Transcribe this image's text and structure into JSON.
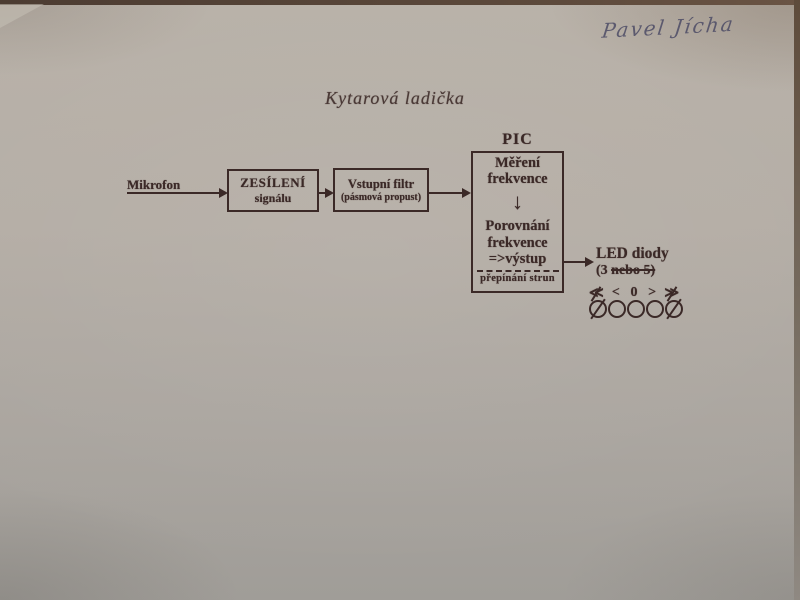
{
  "photo": {
    "handwritten_name": "Pavel Jícha",
    "ink_color": "#3b2927",
    "handwriting_color": "#4d4c66",
    "paper_color": "#b2aba3"
  },
  "title": "Kytarová ladička",
  "diagram": {
    "input_label": "Mikrofon",
    "amplifier_box": {
      "line1": "ZESÍLENÍ",
      "line2": "signálu"
    },
    "filter_box": {
      "line1": "Vstupní filtr",
      "line2": "(pásmová propust)"
    },
    "pic_block": {
      "title": "PIC",
      "step1_line1": "Měření",
      "step1_line2": "frekvence",
      "step2_line1": "Porovnání",
      "step2_line2": "frekvence",
      "step2_line3": "=>výstup",
      "footer": "přepínání strun"
    },
    "output": {
      "label": "LED diody",
      "count_prefix": "(3 ",
      "count_struck": "nebo 5)",
      "indicator_symbols": [
        "≪",
        "<",
        "0",
        ">",
        "≫"
      ],
      "led_count": 5
    },
    "icons": {
      "arrow_down": "↓"
    }
  }
}
